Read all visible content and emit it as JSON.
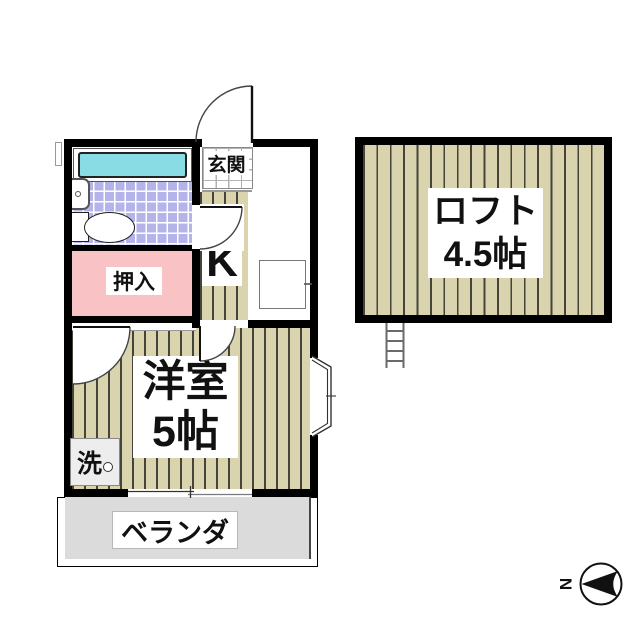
{
  "rooms": {
    "genkan": "玄関",
    "kitchen": "K",
    "closet": "押入",
    "western_room_name": "洋室",
    "western_room_size": "5帖",
    "laundry": "洗",
    "veranda": "ベランダ",
    "loft_name": "ロフト",
    "loft_size": "4.5帖"
  },
  "compass": {
    "north_label": "N"
  },
  "colors": {
    "wood_floor": "#d9d4ae",
    "tile_floor": "#b4b4ea",
    "bathtub": "#8adce4",
    "closet_pink": "#f9c3c6",
    "veranda_gray": "#dbdbdb",
    "wall": "#000000"
  }
}
